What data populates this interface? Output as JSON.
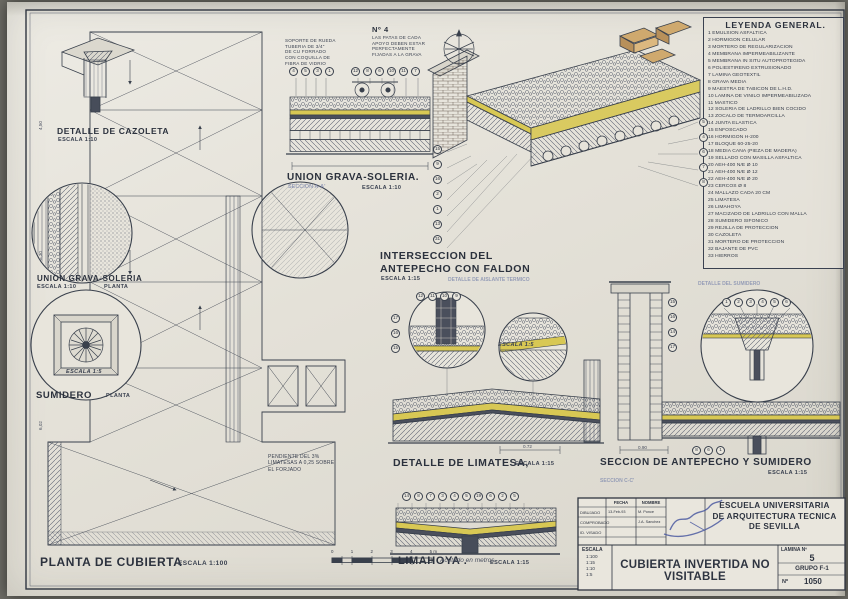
{
  "colors": {
    "paper": "#e6e3da",
    "ink": "#39404c",
    "insulation_yellow": "#d8c854",
    "brick_tan": "#cfa96e",
    "pencil_blue": "#7d88ad"
  },
  "legend": {
    "title": "LEYENDA GENERAL.",
    "items": [
      "1  EMULSION ASFALTICA",
      "2  HORMIGON CELULAR",
      "3  MORTERO DE REGULARIZACION",
      "4  MEMBRANA IMPERMEABILIZANTE",
      "5  MEMBRANA IN SITU AUTOPROTEGIDA",
      "6  POLIESTIRENO EXTRUSIONADO",
      "7  LAMINA GEOTEXTIL",
      "8  GRAVA MEDIA",
      "9  MAESTRA DE TABICON DE L.H.D.",
      "10 LAMINA DE VINILO IMPERMEABILIZADA",
      "11 MASTICO",
      "12 SOLERIA DE LADRILLO BIEN COCIDO",
      "13 ZOCALO DE TERMOARCILLA",
      "14 JUNTA ELASTICA",
      "15 ENFOSCADO",
      "16 HORMIGON H-200",
      "17 BLOQUE 60-25-20",
      "18 MEDIA CAÑA (PIEZA DE MADERA)",
      "19 SELLADO CON MASILLA ASFALTICA",
      "20 AEH-400 N/E Ø 10",
      "21 AEH-400 N/E Ø 12",
      "22 AEH-400 N/E Ø 20",
      "23 CERCOS Ø 8",
      "24 MALLAZO CADA 20 CM",
      "25 LIMATESA",
      "26 LIMAHOYA",
      "27 MACIZADO DE LADRILLO CON MALLA",
      "28 SUMIDERO SIFONICO",
      "29 REJILLA DE PROTECCION",
      "30 CAZOLETA",
      "31 MORTERO DE PROTECCION",
      "32 BAJANTE DE PVC",
      "33 HIERROS"
    ]
  },
  "captions": {
    "cazoleta": {
      "title": "DETALLE DE CAZOLETA",
      "escala": "ESCALA 1:10"
    },
    "union_top": {
      "title": "UNION GRAVA-SOLERIA.",
      "escala": "ESCALA 1:10",
      "seccion": "SECCION A-A'",
      "no4": "Nº 4"
    },
    "union_left": {
      "title": "UNION GRAVA-SOLERIA",
      "escala": "ESCALA 1:10",
      "planta": "PLANTA"
    },
    "sumidero": {
      "title": "SUMIDERO",
      "planta": "PLANTA",
      "circle_scale": "ESCALA 1:5"
    },
    "interseccion": {
      "title": "INTERSECCION DEL\nANTEPECHO CON FALDON",
      "escala": "ESCALA 1:15",
      "faint": "DETALLE DE AISLANTE TERMICO"
    },
    "limatesa": {
      "title": "DETALLE DE LIMATESA,",
      "escala": "ESCALA 1:15",
      "circle_scale": "ESCALA 1:5"
    },
    "antepecho": {
      "title": "SECCION DE ANTEPECHO Y SUMIDERO",
      "escala": "ESCALA 1:15",
      "seccion": "SECCION C-C'",
      "faint": "DETALLE DEL SUMIDERO"
    },
    "limahoya": {
      "title": "LIMAHOYA .",
      "escala": "ESCALA 1:15"
    },
    "planta": {
      "title": "PLANTA DE CUBIERTA",
      "escala": "ESCALA 1:100",
      "acotado": "Acotado en metros"
    }
  },
  "notes": {
    "soporte": "SOPORTE DE RUEDA\nTUBERIA DE 3/4\"\nDE CU FORRADO\nCON COQUILLA DE\nFIBRA DE VIDRIO",
    "no4_note": "LAS PATAS DE CADA\nAPOYO DEBEN ESTAR\nPERFECTAMENTE\nFIJADAS A LA GRAVA",
    "pendiente": "PENDIENTE DEL 3%\nLIMATESAS A 0,25 SOBRE\nEL FORJADO"
  },
  "markers": {
    "union_left": [
      "4",
      "5",
      "3",
      "1"
    ],
    "union_right": [
      "12",
      "8",
      "6",
      "10",
      "11",
      "7"
    ],
    "axon_left": [
      "15",
      "9",
      "16",
      "2",
      "1",
      "13",
      "31"
    ],
    "axon_right": [
      "5",
      "4",
      "6",
      "7",
      "8"
    ],
    "limatesa_row": [
      "12",
      "11",
      "10",
      "9"
    ],
    "limatesa_col": [
      "17",
      "16",
      "15"
    ],
    "sumidero_arc": [
      "1",
      "2",
      "3",
      "4",
      "5",
      "6"
    ],
    "antepecho_col": [
      "15",
      "16",
      "14",
      "17"
    ],
    "antepecho_row": [
      "8",
      "6",
      "1"
    ],
    "limahoya_row": [
      "14",
      "8",
      "7",
      "3",
      "4",
      "5",
      "19",
      "6",
      "2",
      "5"
    ]
  },
  "dims": {
    "limatesa": "0.72",
    "antepecho": "0.90",
    "plan_v1": "4,50",
    "plan_v2": "5,30",
    "plan_v3": "6,02"
  },
  "scalebar": {
    "labels": [
      "0",
      "1",
      "2",
      "3",
      "4",
      "5 m"
    ]
  },
  "titleblock": {
    "school": "ESCUELA UNIVERSITARIA\nDE ARQUITECTURA TECNICA\nDE SEVILLA",
    "title": "CUBIERTA INVERTIDA NO VISITABLE",
    "lamina_label": "LAMINA Nº",
    "lamina_value": "5",
    "grupo": "GRUPO F-1",
    "num_label": "Nº",
    "num_value": "1050",
    "escala_label": "ESCALA",
    "escalas": [
      "1:100",
      "1:15",
      "1:10",
      "1:5"
    ],
    "col_fecha": "FECHA",
    "col_nombre": "NOMBRE",
    "rows": [
      {
        "label": "DIBUJADO",
        "fecha": "13-Feb-93",
        "nombre": "M. Ponce"
      },
      {
        "label": "COMPROBADO",
        "fecha": "",
        "nombre": "J.A. Sanchez"
      },
      {
        "label": "ID. VISADO",
        "fecha": "",
        "nombre": ""
      }
    ]
  }
}
